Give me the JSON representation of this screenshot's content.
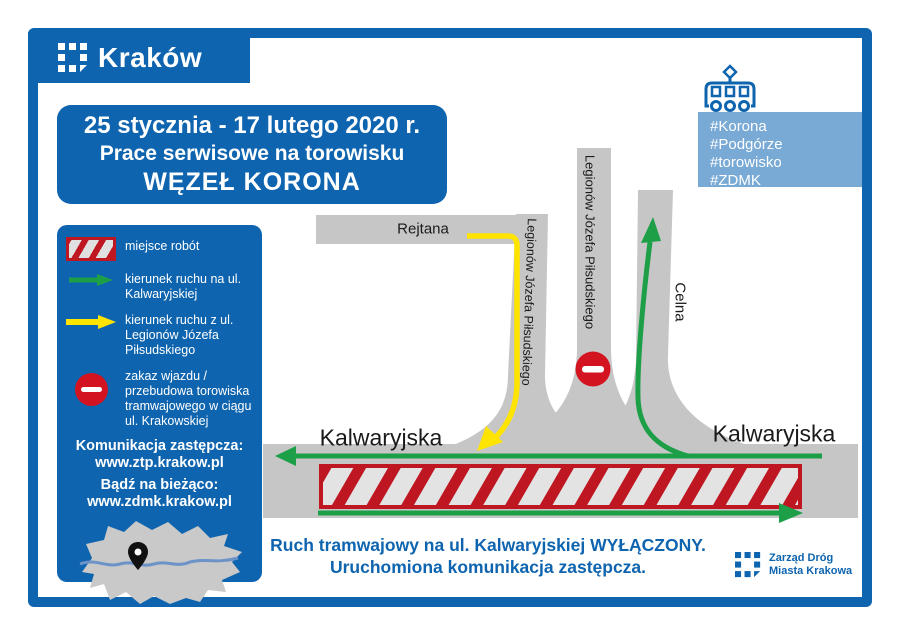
{
  "colors": {
    "brand_blue": "#0e64ae",
    "light_blue": "#79aad5",
    "road_gray": "#c6c6c6",
    "works_red": "#bf1722",
    "sign_red": "#d31420",
    "route_green": "#1d9f48",
    "route_yellow": "#ffe400"
  },
  "header": {
    "city_label": "Kraków"
  },
  "title_box": {
    "line1": "25 stycznia - 17 lutego 2020 r.",
    "line2": "Prace serwisowe na torowisku",
    "line3": "WĘZEŁ KORONA"
  },
  "hashtags": {
    "items": [
      "#Korona",
      "#Podgórze",
      "#torowisko",
      "#ZDMK"
    ]
  },
  "legend": {
    "items": [
      {
        "icon": "roadworks-hatch",
        "label": "miejsce robót"
      },
      {
        "icon": "green-arrow",
        "label": "kierunek ruchu na ul. Kalwaryjskiej"
      },
      {
        "icon": "yellow-arrow",
        "label": "kierunek ruchu z ul. Legionów Józefa Piłsudskiego"
      },
      {
        "icon": "no-entry-sign",
        "label": "zakaz wjazdu / przebudowa torowiska tramwajowego w ciągu ul. Krakowskiej"
      }
    ],
    "replacement_heading": "Komunikacja zastępcza:",
    "replacement_url": "www.ztp.krakow.pl",
    "updated_heading": "Bądź na bieżąco:",
    "updated_url": "www.zdmk.krakow.pl"
  },
  "streets": {
    "rejtana": "Rejtana",
    "legionow_left": "Legionów Józefa Piłsudskiego",
    "legionow_mid": "Legionów Józefa Piłsudskiego",
    "celna": "Celna",
    "kalwaryjska_left": "Kalwaryjska",
    "kalwaryjska_right": "Kalwaryjska"
  },
  "caption": {
    "line1": "Ruch tramwajowy na ul. Kalwaryjskiej WYŁĄCZONY.",
    "line2": "Uruchomiona komunikacja zastępcza."
  },
  "footer": {
    "line1": "Zarząd Dróg",
    "line2": "Miasta Krakowa"
  }
}
